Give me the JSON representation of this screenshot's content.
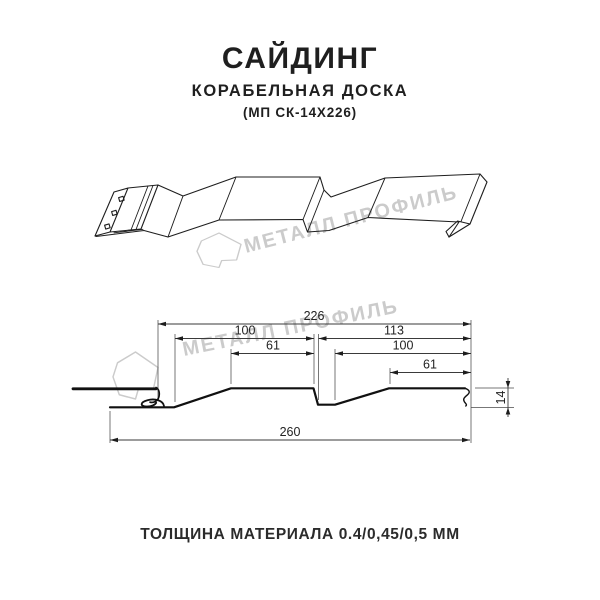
{
  "header": {
    "title": "САЙДИНГ",
    "subtitle": "КОРАБЕЛЬНАЯ ДОСКА",
    "model": "(МП СК-14Х226)"
  },
  "watermark": {
    "brand": "МЕТАЛЛ ПРОФИЛЬ"
  },
  "cross_section": {
    "dims": {
      "d226": "226",
      "d100_left": "100",
      "d113": "113",
      "d61_left": "61",
      "d100_right": "100",
      "d61_right": "61",
      "d14": "14",
      "d260": "260"
    }
  },
  "footer": {
    "thickness": "ТОЛЩИНА МАТЕРИАЛА 0.4/0,45/0,5 ММ"
  },
  "colors": {
    "line": "#1e1e1e",
    "dimension": "#3a3a3a",
    "watermark": "#cbcbcb",
    "background": "#ffffff"
  }
}
